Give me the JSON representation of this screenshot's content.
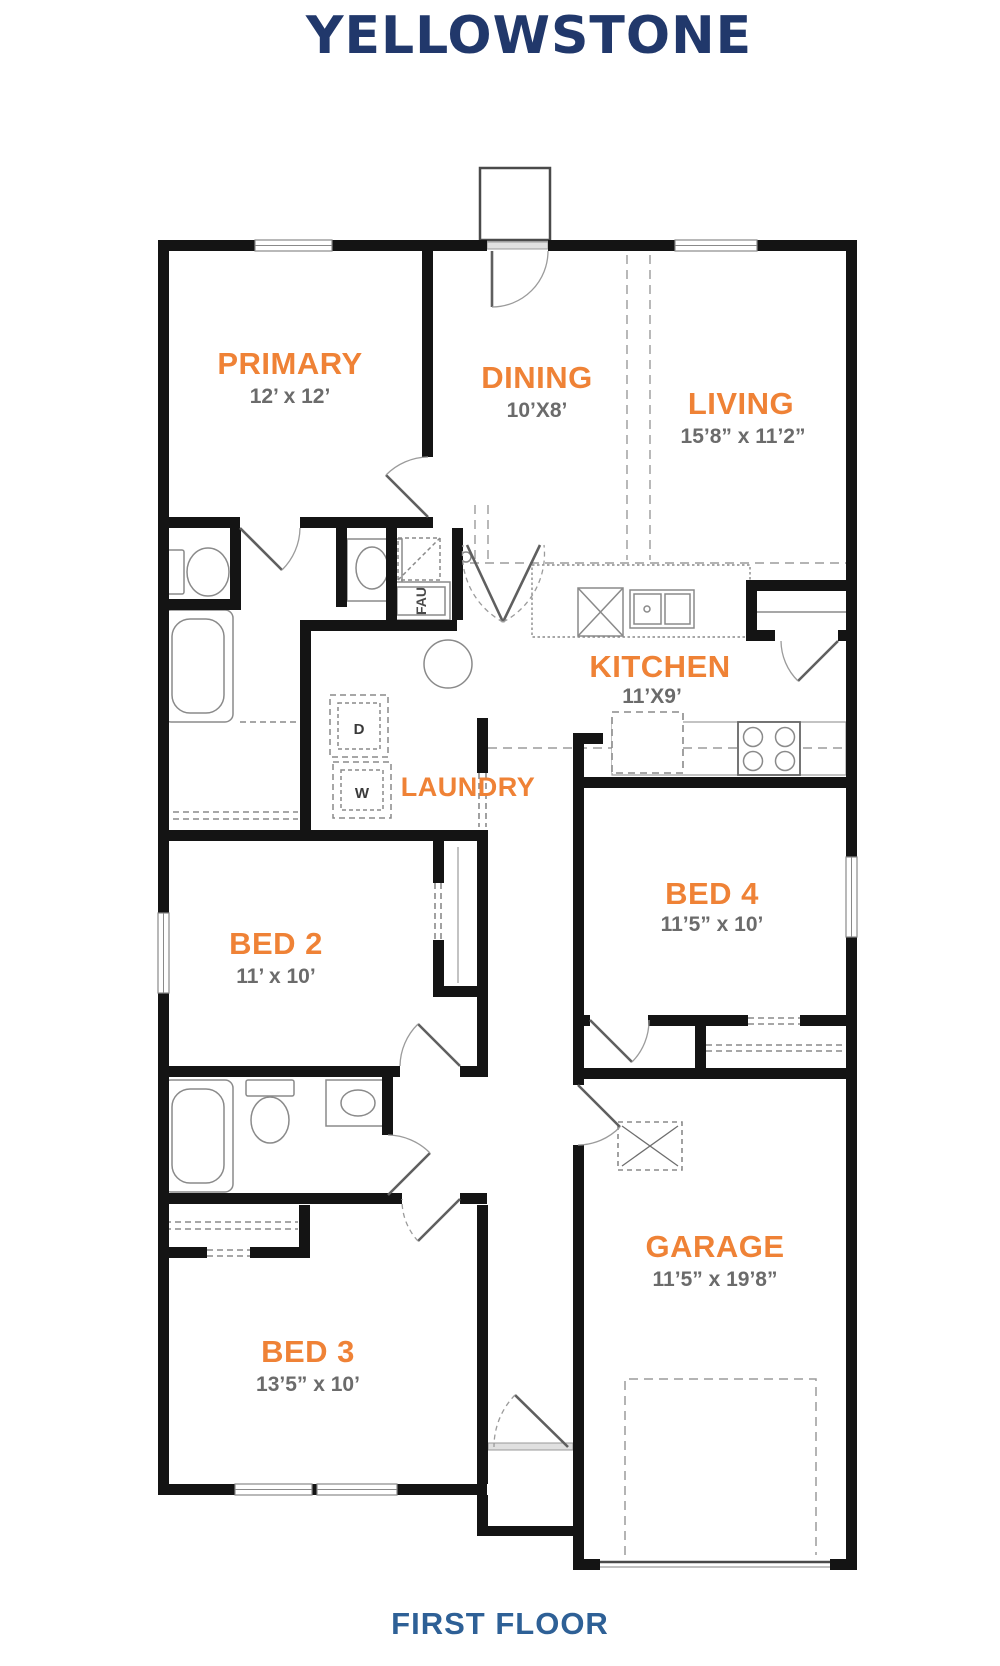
{
  "title": "YELLOWSTONE",
  "floor_label": "FIRST FLOOR",
  "colors": {
    "title_navy": "#21386b",
    "floor_label_blue": "#2e6096",
    "room_name_orange": "#ef8236",
    "dims_gray": "#6b6b6b",
    "wall_black": "#141414"
  },
  "rooms": [
    {
      "name": "PRIMARY",
      "dims": "12’ x 12’"
    },
    {
      "name": "DINING",
      "dims": "10’X8’"
    },
    {
      "name": "LIVING",
      "dims": "15’8” x 11’2”"
    },
    {
      "name": "KITCHEN",
      "dims": "11’X9’"
    },
    {
      "name": "LAUNDRY",
      "dims": ""
    },
    {
      "name": "BED 2",
      "dims": "11’ x 10’"
    },
    {
      "name": "BED 4",
      "dims": "11’5” x 10’"
    },
    {
      "name": "BED 3",
      "dims": "13’5” x 10’"
    },
    {
      "name": "GARAGE",
      "dims": "11’5” x 19’8”"
    }
  ],
  "fixtures": {
    "fau_label": "FAU",
    "dryer_label": "D",
    "washer_label": "W"
  }
}
